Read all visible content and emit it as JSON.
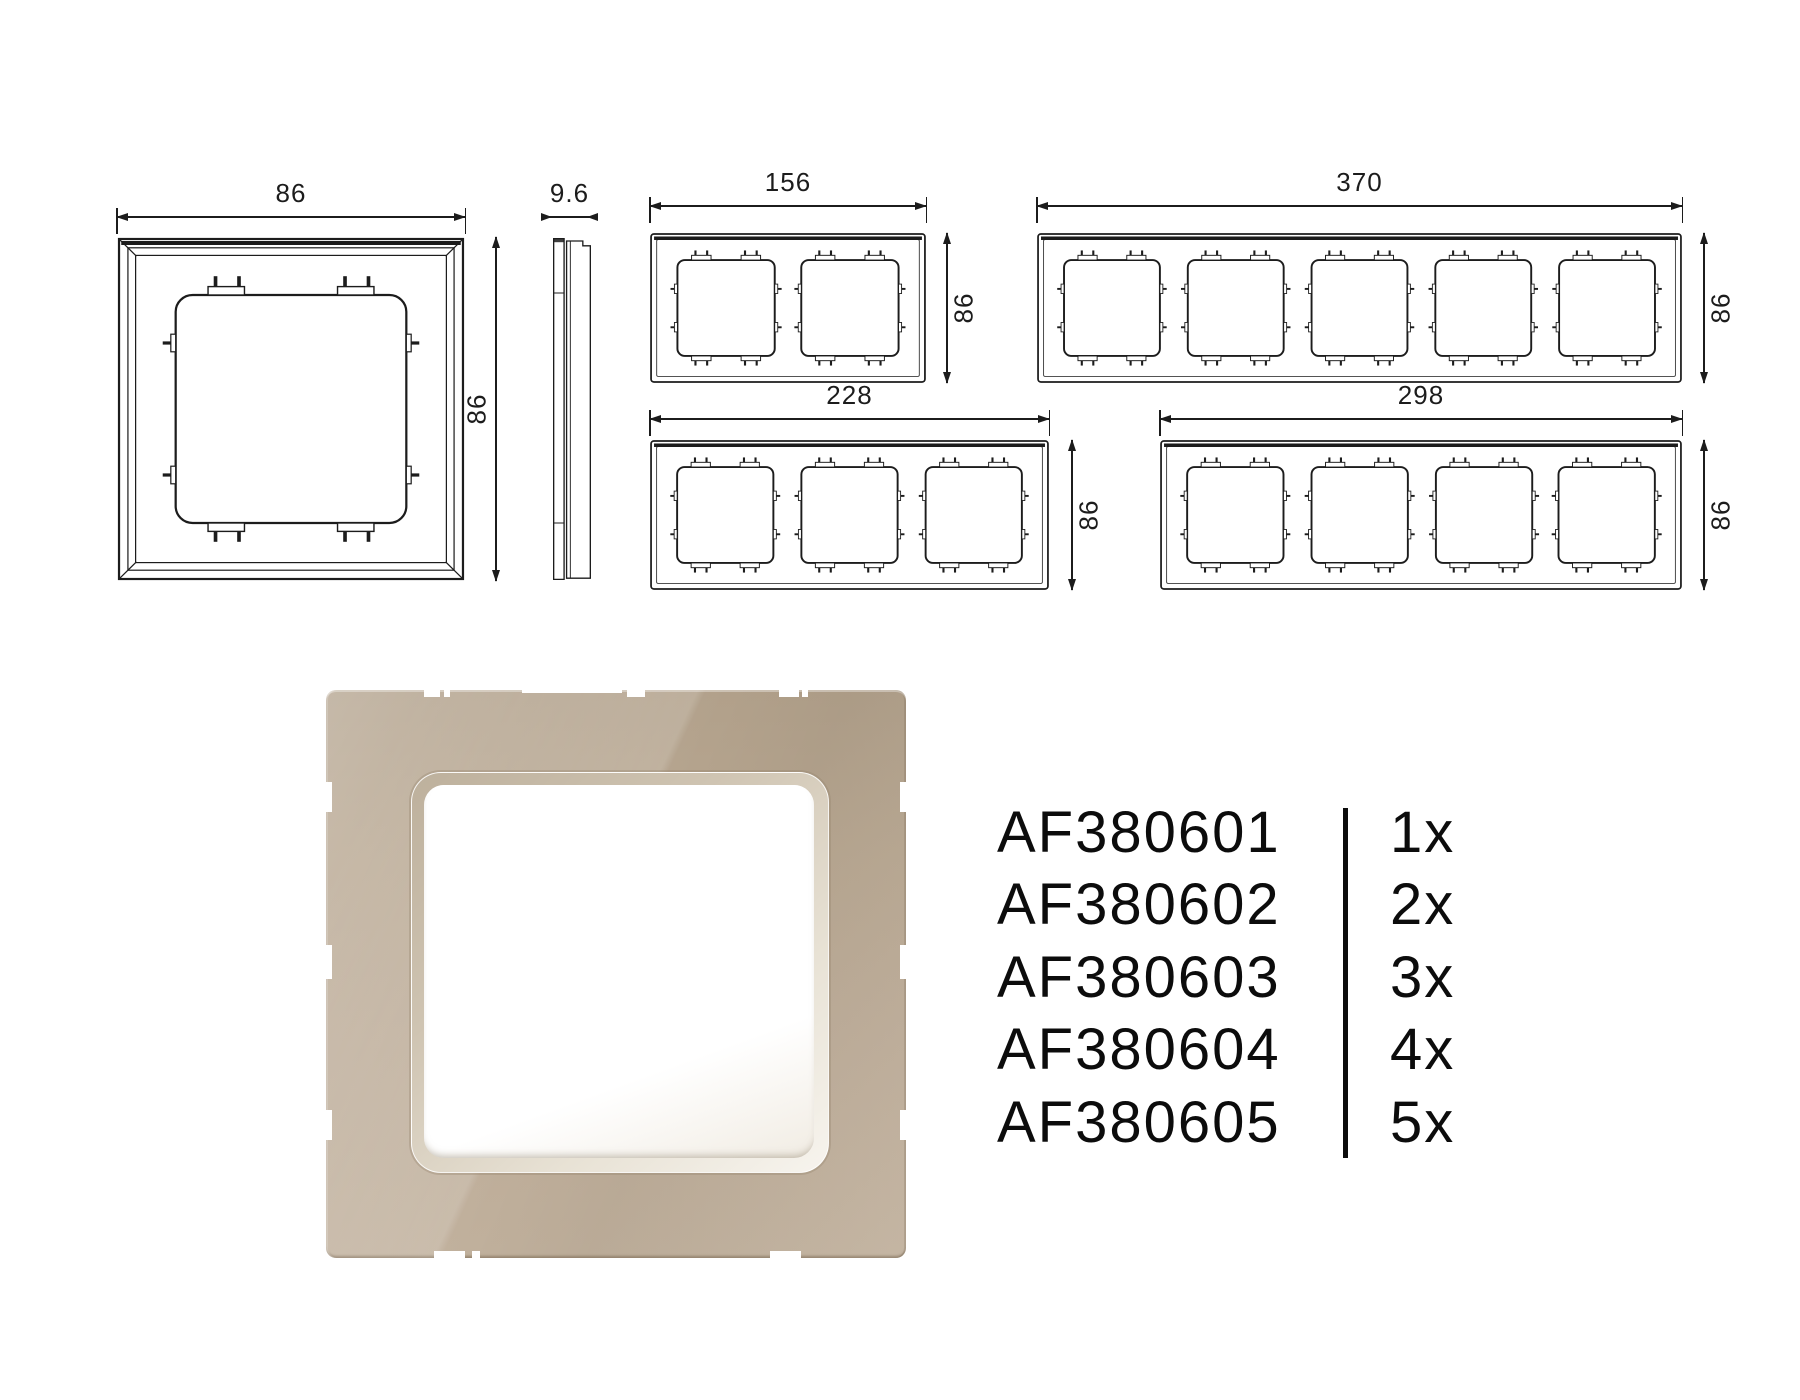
{
  "sheet": {
    "background": "#ffffff",
    "ink_color": "#1c1c1c"
  },
  "drawings": {
    "single_front": {
      "view": "front view 1-gang frame",
      "width_label": "86",
      "height_label": "86"
    },
    "side_view": {
      "view": "side profile",
      "depth_label": "9.6"
    },
    "gang2": {
      "view": "front view 2-gang frame",
      "width_label": "156",
      "height_label": "86"
    },
    "gang5": {
      "view": "front view 5-gang frame",
      "width_label": "370",
      "height_label": "86"
    },
    "gang3": {
      "view": "front view 3-gang frame",
      "width_label": "228",
      "height_label": "86"
    },
    "gang4": {
      "view": "front view 4-gang frame",
      "width_label": "298",
      "height_label": "86"
    }
  },
  "product_render": {
    "description": "beige glass 1-gang frame render",
    "glass_color": "#bcab97",
    "bezel_color": "#e8e2d5",
    "opening_color": "#ffffff"
  },
  "parts": {
    "rows": [
      {
        "sku": "AF380601",
        "qty": "1x"
      },
      {
        "sku": "AF380602",
        "qty": "2x"
      },
      {
        "sku": "AF380603",
        "qty": "3x"
      },
      {
        "sku": "AF380604",
        "qty": "4x"
      },
      {
        "sku": "AF380605",
        "qty": "5x"
      }
    ]
  }
}
